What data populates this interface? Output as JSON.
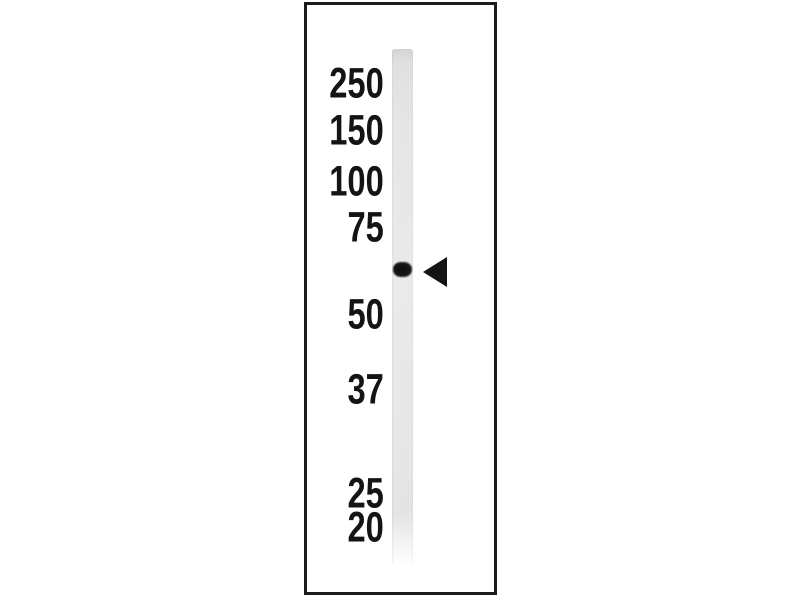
{
  "figure": {
    "kind": "western-blot-single-lane",
    "markers": [
      "250",
      "150",
      "100",
      "75",
      "50",
      "37",
      "25",
      "20"
    ],
    "band": {
      "indicator": "left-pointing arrowhead",
      "position_between_markers": [
        "75",
        "50"
      ]
    },
    "colors": {
      "background": "#ffffff",
      "panel_border": "#1c1c1c",
      "lane": "#e6e6e6",
      "band": "#131313",
      "arrowhead": "#131313",
      "marker_text": "#141414"
    }
  }
}
